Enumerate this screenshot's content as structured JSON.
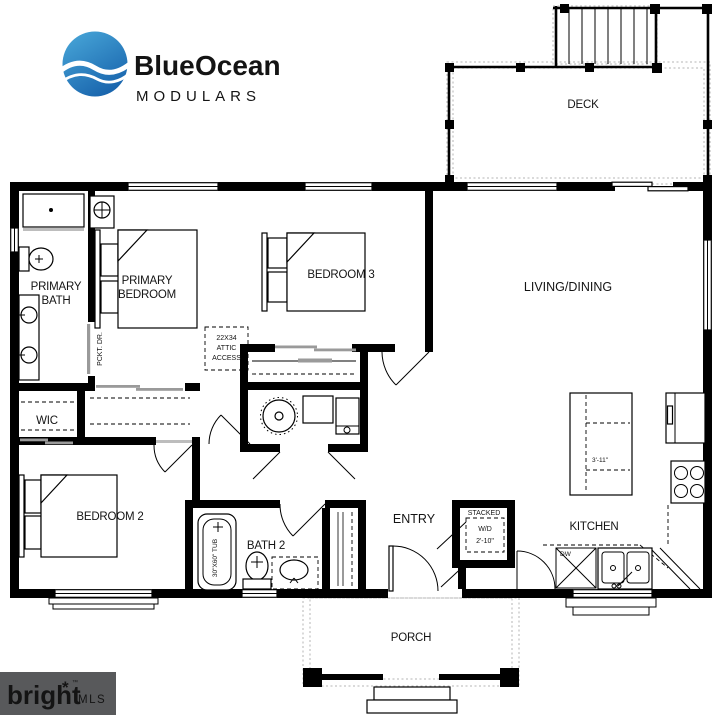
{
  "colors": {
    "wall": "#000000",
    "door_gray": "#9a9a9a",
    "logo_blue": "#2e86c5",
    "logo_dark": "#414042",
    "logo_gray": "#77787b",
    "mls_bg": "#58595b",
    "mls_orange": "#e8683c"
  },
  "logo": {
    "word1": "Blue",
    "word2": "Ocean",
    "word3": "MODULARS"
  },
  "rooms": {
    "deck": "DECK",
    "primary_bath_1": "PRIMARY",
    "primary_bath_2": "BATH",
    "primary_bedroom_1": "PRIMARY",
    "primary_bedroom_2": "BEDROOM",
    "bedroom3": "BEDROOM 3",
    "living_dining": "LIVING/DINING",
    "wic": "WIC",
    "bedroom2": "BEDROOM 2",
    "bath2": "BATH 2",
    "entry": "ENTRY",
    "kitchen": "KITCHEN",
    "porch": "PORCH"
  },
  "annotations": {
    "pocket_door": "PCKT. DR.",
    "attic_1": "22X34",
    "attic_2": "ATTIC",
    "attic_3": "ACCESS",
    "tub": "30\"X60\" TUB",
    "wd_1": "STACKED",
    "wd_2": "W/D",
    "wd_3": "2'-10\"",
    "island": "3'-11\"",
    "dw": "DW"
  },
  "watermark": {
    "brand": "bright",
    "star": "*",
    "tm": "™",
    "suffix": "MLS"
  }
}
